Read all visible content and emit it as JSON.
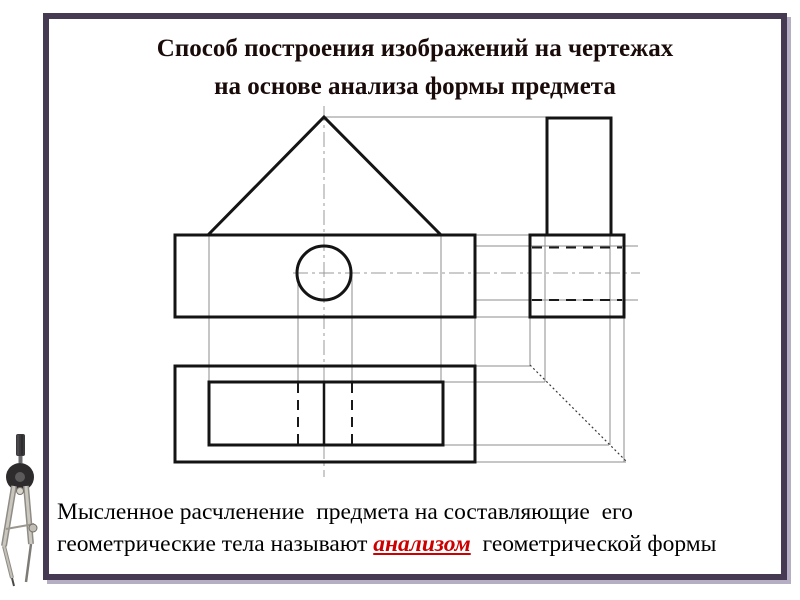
{
  "slide": {
    "title_line1": "Способ построения изображений на чертежах",
    "title_line2": "на основе анализа формы предмета",
    "body": {
      "before": "Мысленное расчленение  предмета на составляющие  его геометрические тела называют ",
      "highlight": "анализом",
      "after": "  геометрической формы"
    },
    "colors": {
      "frame": "#463a52",
      "frame_shadow": "#b6aec3",
      "title": "#190b09",
      "body_text": "#000000",
      "highlight": "#cc0000",
      "outline": "#141414",
      "dashed": "#1a1a1a",
      "construction": "#8c8c8c",
      "centerline": "#9a9a9a",
      "diagonal": "#3a3a3a"
    }
  },
  "drawing": {
    "description": "Three orthographic views (front, left-side, top) of a box with a triangular roof prism and a horizontal cylindrical hole, with construction transfer lines and 45-degree diagonal",
    "front_view": "triangle roof on rectangle with circle hole",
    "side_view": "square box with tall rectangle on top and hidden dashed hole lines",
    "top_view": "outer rectangle with inner prism footprint, ridge line and dashed hole lines",
    "thick_rects": [
      {
        "x": 175,
        "y": 235,
        "w": 300,
        "h": 82
      },
      {
        "x": 530,
        "y": 235,
        "w": 94,
        "h": 82
      },
      {
        "x": 547,
        "y": 118,
        "w": 64,
        "h": 117
      },
      {
        "x": 175,
        "y": 366,
        "w": 300,
        "h": 96
      },
      {
        "x": 209,
        "y": 382,
        "w": 234,
        "h": 63
      }
    ],
    "thick_polylines": [
      [
        [
          208,
          235
        ],
        [
          324,
          117
        ],
        [
          441,
          235
        ]
      ]
    ],
    "thick_circles": [
      {
        "cx": 324,
        "cy": 273,
        "r": 27
      }
    ],
    "medium_lines": [
      [
        324,
        382,
        324,
        445
      ]
    ],
    "dashed_lines": [
      [
        532,
        247.5,
        622,
        247.5
      ],
      [
        532,
        300,
        622,
        300
      ],
      [
        298,
        383,
        298,
        444
      ],
      [
        352,
        383,
        352,
        444
      ]
    ],
    "thin_lines": [
      [
        324,
        117,
        547,
        117
      ],
      [
        475,
        235,
        530,
        235
      ],
      [
        475,
        246,
        638,
        246
      ],
      [
        475,
        300,
        638,
        300
      ],
      [
        475,
        317,
        530,
        317
      ],
      [
        475,
        366,
        530,
        366
      ],
      [
        443,
        382,
        545,
        382
      ],
      [
        443,
        445,
        609,
        445
      ],
      [
        475,
        462,
        626,
        462
      ],
      [
        209,
        235,
        209,
        382
      ],
      [
        298,
        273,
        298,
        382
      ],
      [
        352,
        273,
        352,
        382
      ],
      [
        441,
        235,
        441,
        382
      ],
      [
        475,
        317,
        475,
        366
      ],
      [
        530,
        317,
        530,
        366
      ],
      [
        545,
        235,
        545,
        382
      ],
      [
        610,
        235,
        610,
        445
      ],
      [
        624,
        317,
        624,
        462
      ]
    ],
    "dashdot_lines": [
      [
        324,
        106,
        324,
        477
      ],
      [
        293,
        273,
        640,
        273
      ]
    ],
    "diagonal_line": [
      530,
      365,
      626,
      461
    ]
  }
}
